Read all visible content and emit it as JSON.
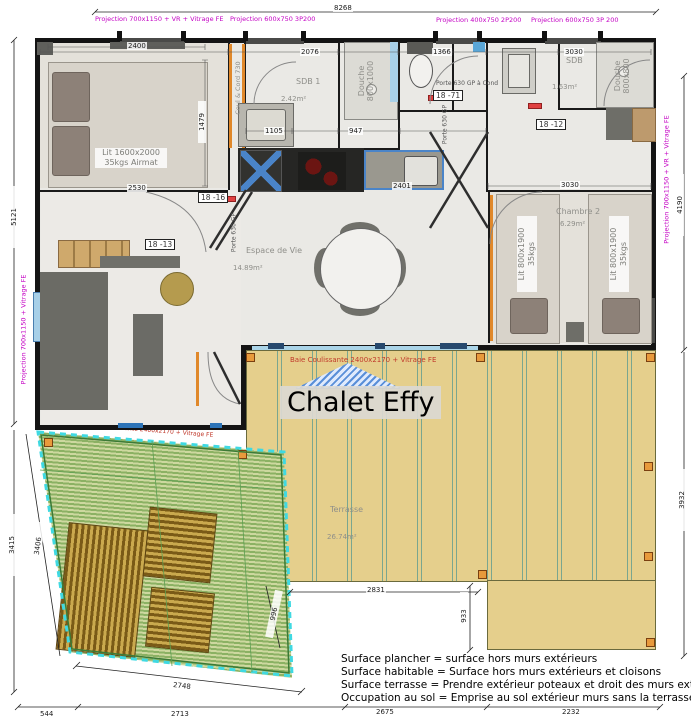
{
  "title": "Chalet Effy",
  "baie": {
    "main": "Baie Coulissante 2400x2170 + Vitrage FE",
    "deck": "Baie Coulissante 2400x2170 + Vitrage FE"
  },
  "projections": {
    "top1": "Projection 700x1150 + VR + Vitrage FE",
    "top2": "Projection 600x750 3P200",
    "top3": "Projection 400x750 2P200",
    "top4": "Projection 600x750 3P 200",
    "left": "Projection 700x1150 + Vitrage FE",
    "right": "Projection 700x1150 + VR + Vitrage FE"
  },
  "rooms": {
    "sdb1": "SDB 1",
    "sdb1_area": "2.42m²",
    "douche1": "Douche\n800x1000",
    "couloir": "Coul & Cord 730",
    "sdb2": "SDB",
    "sdb2_area": "1.63m²",
    "douche2": "Douche\n800x800",
    "vie": "Espace de Vie",
    "vie_area": "14.89m²",
    "chambre2": "Chambre 2",
    "chambre2_area": "6.29m²",
    "terrasse": "Terrasse",
    "terrasse_area": "26.74m²"
  },
  "furniture": {
    "bed_main": "Lit 1600x2000\n35kgs Airmat",
    "bed_small": "Lit 800x1900\n35kgs"
  },
  "doors": {
    "porte_cond": "Porte 630 GP à Cond",
    "porte_gp": "Porte 630 GP",
    "tag_1871": "18 -71",
    "tag_1812": "18 -12",
    "tag_1816": "18 -16",
    "tag_1813": "18 -13"
  },
  "dims": {
    "top": "8268",
    "left_upper": "5121",
    "left_lower": "3415",
    "right_upper": "4190",
    "right_lower": "3932",
    "bottom_1": "544",
    "bottom_2": "2713",
    "bottom_3": "2675",
    "bottom_4": "2232",
    "deck_bottom": "2748",
    "deck_side": "3406",
    "terr_bottom": "2831",
    "notch_v": "933",
    "notch_d": "996",
    "c1_top": "2400",
    "c1_bottom": "2530",
    "c1_side": "1479",
    "sdb_top": "2076",
    "wc_top": "1366",
    "sdb2_top": "3030",
    "ch2_top": "3030",
    "washer": "1105",
    "sink": "947",
    "kitchen": "2401"
  },
  "legend": [
    "Surface plancher = surface hors murs extérieurs",
    "Surface habitable = Surface hors murs extérieurs et cloisons",
    "Surface terrasse = Prendre extérieur poteaux et droit des murs extérieurs",
    "Occupation au sol = Emprise au sol extérieur murs sans la terrasse\""
  ],
  "colors": {
    "projection": "#c400c4",
    "baie_red": "#c0392b",
    "terrace_tan": "#e5cf8c",
    "deck_green": "#8bb163",
    "wall": "#141414",
    "door_orange": "#e0882a",
    "window_blue": "#a8d0e8"
  }
}
